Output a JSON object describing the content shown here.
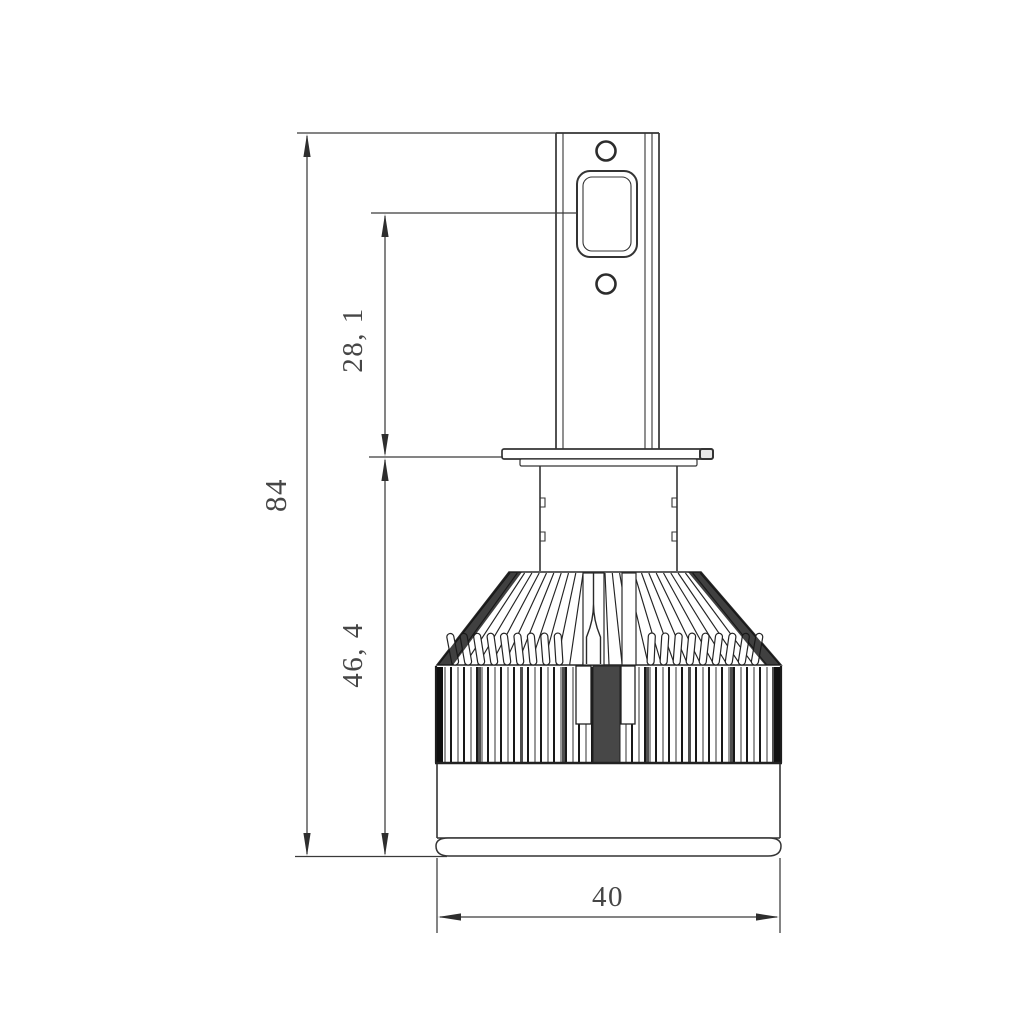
{
  "drawing": {
    "kind": "technical-dimension-drawing",
    "dimensions": {
      "overall_height": "84",
      "upper_section_height": "28, 1",
      "lower_section_height": "46, 4",
      "base_width": "40"
    },
    "colors": {
      "line": "#343434",
      "dimension_line": "#3a3a3a",
      "background": "#ffffff"
    }
  }
}
